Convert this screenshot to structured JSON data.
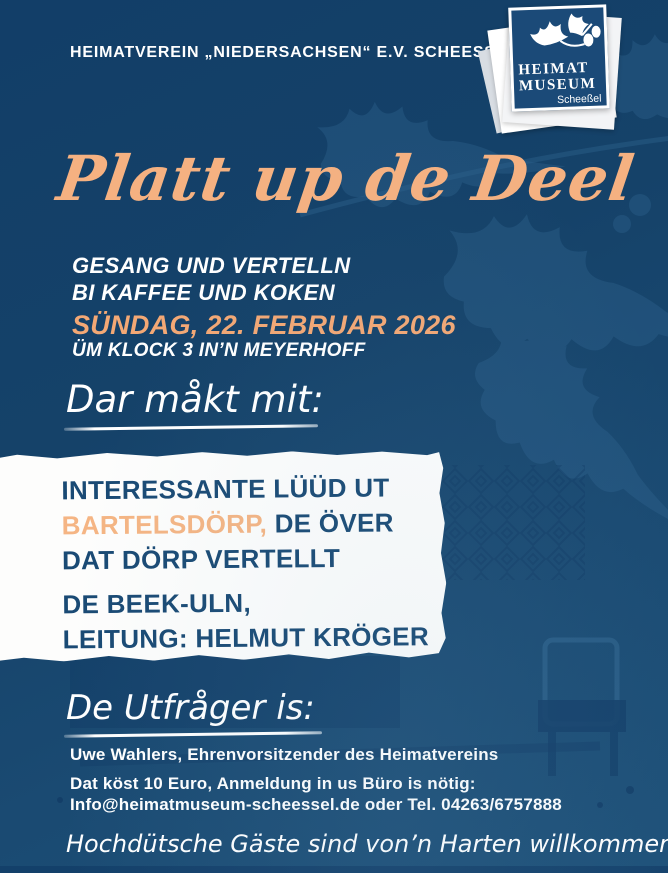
{
  "poster": {
    "banner": {
      "text": "HEIMATVEREIN „NIEDERSACHSEN“ E.V. SCHEESSEL"
    },
    "logo": {
      "title_line1": "HEIMAT",
      "title_line2": "MUSEUM",
      "subtitle": "Scheeßel",
      "icon": "oak-branch-acorns-icon"
    },
    "title": {
      "text": "Platt up de Deel"
    },
    "intro": {
      "line1": "GESANG UND VERTELLN",
      "line2": "BI KAFFEE UND KOKEN"
    },
    "event": {
      "date": "SÜNDAG, 22. FEBRUAR 2026",
      "time_place": "ÜM KLOCK 3 IN’N MEYERHOFF"
    },
    "participants": {
      "heading": "Dar måkt mit:",
      "line1": "INTERESSANTE LÜÜD UT",
      "line2_highlight": "BARTELSDÖRP,",
      "line2_rest": " DE ÖVER",
      "line3": "DAT DÖRP VERTELLT",
      "line4": "DE BEEK-ULN,",
      "line5": "LEITUNG: HELMUT KRÖGER"
    },
    "host": {
      "heading": "De Utfråger is:",
      "name_line": "Uwe Wahlers, Ehrenvorsitzender des Heimatvereins"
    },
    "info": {
      "price_line": "Dat köst 10 Euro, Anmeldung in us Büro is nötig:",
      "contact_line": "Info@heimatmuseum-scheessel.de oder Tel. 04263/6757888"
    },
    "closing": {
      "text": "Hochdütsche Gäste sind von’n Harten willkommen!"
    },
    "colors": {
      "background_top": "#123e68",
      "background_bottom": "#1e5179",
      "accent_orange": "#f5b181",
      "date_orange": "#f3a875",
      "box_text_blue": "#1a4a74",
      "logo_square_blue": "#1b4a78",
      "white": "#ffffff"
    },
    "decor": {
      "background_icons": [
        "oak-leaf-silhouette",
        "museum-interior-faint-photo",
        "quilt-pattern"
      ]
    }
  }
}
